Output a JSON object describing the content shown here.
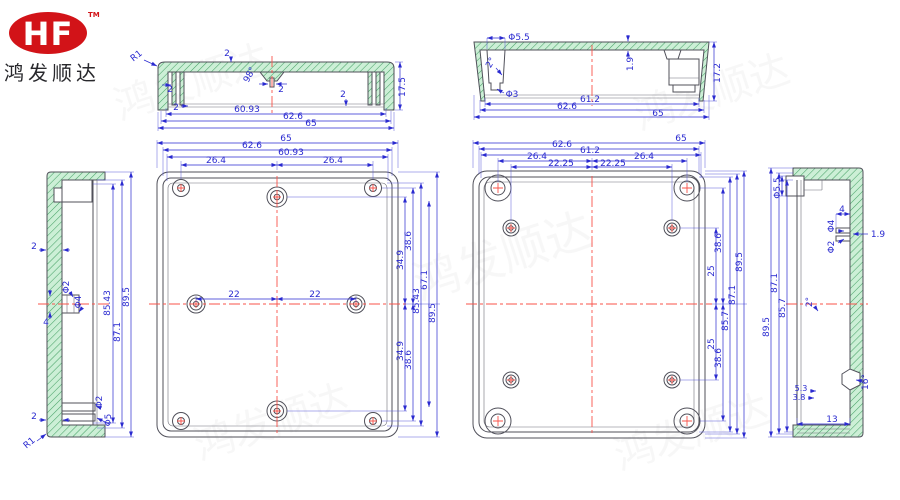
{
  "logo": {
    "brand": "HF",
    "trademark": "TM",
    "company": "鸿发顺达"
  },
  "watermark": {
    "text": "鸿发顺达"
  },
  "colors": {
    "dimension_blue": "#2a2ad0",
    "outline_gray": "#50505a",
    "hatch_green_fill": "#ccefd6",
    "hatch_green_line": "#49a368",
    "centerline_red": "#f9534a",
    "logo_red": "#d21318"
  },
  "dims": {
    "lidsec": {
      "r1": "R1",
      "t2": "2",
      "a98": "98°",
      "s2": "2",
      "f2": "2",
      "b2": "2",
      "r2": "2",
      "h175": "17.5",
      "w6093": "60.93",
      "w626": "62.6",
      "w65": "65"
    },
    "basesec": {
      "d55": "Φ5.5",
      "a2": "2°",
      "d3": "Φ3",
      "t19": "1.9",
      "h172": "17.2",
      "w612": "61.2",
      "w626": "62.6",
      "w65": "65"
    },
    "lidside": {
      "t2": "2",
      "b2": "2",
      "d2": "Φ2",
      "d4": "Φ4",
      "l4": "4",
      "bd2": "Φ2",
      "bd5": "Φ5",
      "r1": "R1",
      "h8543": "85.43",
      "h871": "87.1",
      "h895": "89.5"
    },
    "lidface": {
      "w65": "65",
      "w626": "62.6",
      "w6093": "60.93",
      "c264l": "26.4",
      "c264r": "26.4",
      "c22l": "22",
      "c22r": "22",
      "v349t": "34.9",
      "v386t": "38.6",
      "v349b": "34.9",
      "v386b": "38.6",
      "h671": "67.1",
      "h8543": "85.43",
      "h895": "89.5"
    },
    "baseface": {
      "w65": "65",
      "w626": "62.6",
      "w612": "61.2",
      "c264l": "26.4",
      "c264r": "26.4",
      "c2225l": "22.25",
      "c2225r": "22.25",
      "v25t": "25",
      "v386t": "38.6",
      "v25b": "25",
      "v386b": "38.6",
      "h857": "85.7",
      "h871": "87.1",
      "h895": "89.5"
    },
    "baseside": {
      "d55": "Φ5.5",
      "l4": "4",
      "d4": "Φ4",
      "d2": "Φ2",
      "t19": "1.9",
      "a2": "2°",
      "a16": "16°",
      "v53": "5.3",
      "v38": "3.8",
      "w13": "13",
      "h857": "85.7",
      "h871": "87.1",
      "h895": "89.5"
    }
  }
}
